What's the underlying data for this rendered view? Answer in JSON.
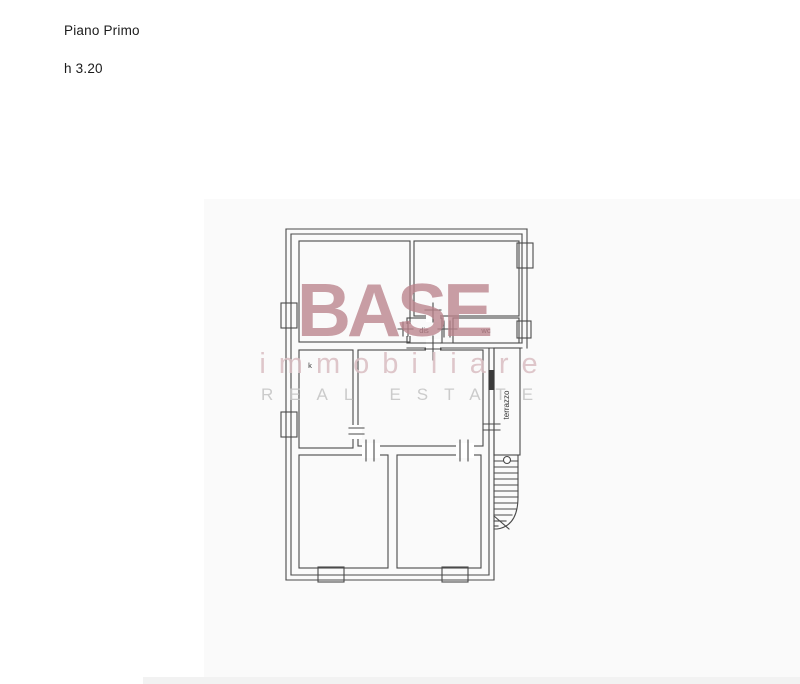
{
  "header": {
    "floor_label": "Piano Primo",
    "height_label": "h 3.20"
  },
  "plan": {
    "room_labels": {
      "dis": "dis",
      "wc": "wc",
      "kitchen": "k",
      "terrace": "terrazzo"
    }
  },
  "watermark": {
    "brand": "BASE",
    "subtitle": "immobiliare",
    "tagline": "REAL ESTATE"
  },
  "colors": {
    "wall_line": "#4a4a4a",
    "door_leaf": "#3a3a3a",
    "label_text": "#333333",
    "watermark_brand": "#bb838c",
    "watermark_subtitle": "#dabec2",
    "watermark_tagline": "#c6c6c6",
    "backdrop": "#fafafa",
    "bottom_strip": "#f2f2f2"
  }
}
